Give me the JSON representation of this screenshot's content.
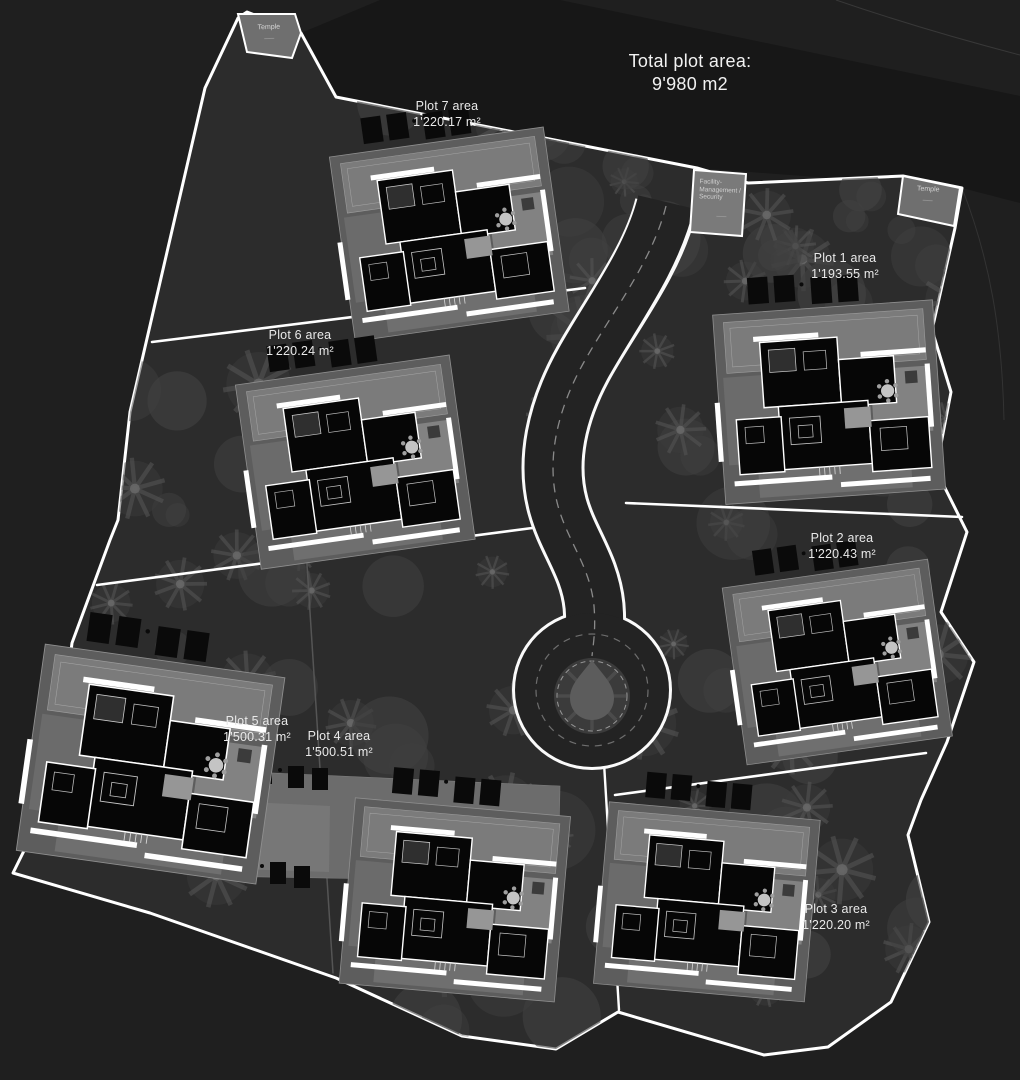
{
  "title": {
    "line1": "Total plot area:",
    "line2": "9'980 m2"
  },
  "plots": [
    {
      "name": "Plot 1 area",
      "area": "1'193.55 m²"
    },
    {
      "name": "Plot 2 area",
      "area": "1'220.43 m²"
    },
    {
      "name": "Plot 3 area",
      "area": "1'220.20 m²"
    },
    {
      "name": "Plot 4 area",
      "area": "1'500.51 m²"
    },
    {
      "name": "Plot 5 area",
      "area": "1'500.31 m²"
    },
    {
      "name": "Plot 6 area",
      "area": "1'220.24 m²"
    },
    {
      "name": "Plot 7 area",
      "area": "1'220.17 m²"
    }
  ],
  "landmarks": {
    "temple_left": {
      "label": "Temple"
    },
    "temple_right": {
      "label": "Temple"
    },
    "facility": {
      "label": "Facility-Management / Security"
    }
  },
  "colors": {
    "background": "#1f1f1f",
    "site_fill": "#2c2c2c",
    "road_fill": "#232323",
    "boundary": "#ffffff",
    "building": "#060606",
    "label_text": "#e9e9e9"
  }
}
